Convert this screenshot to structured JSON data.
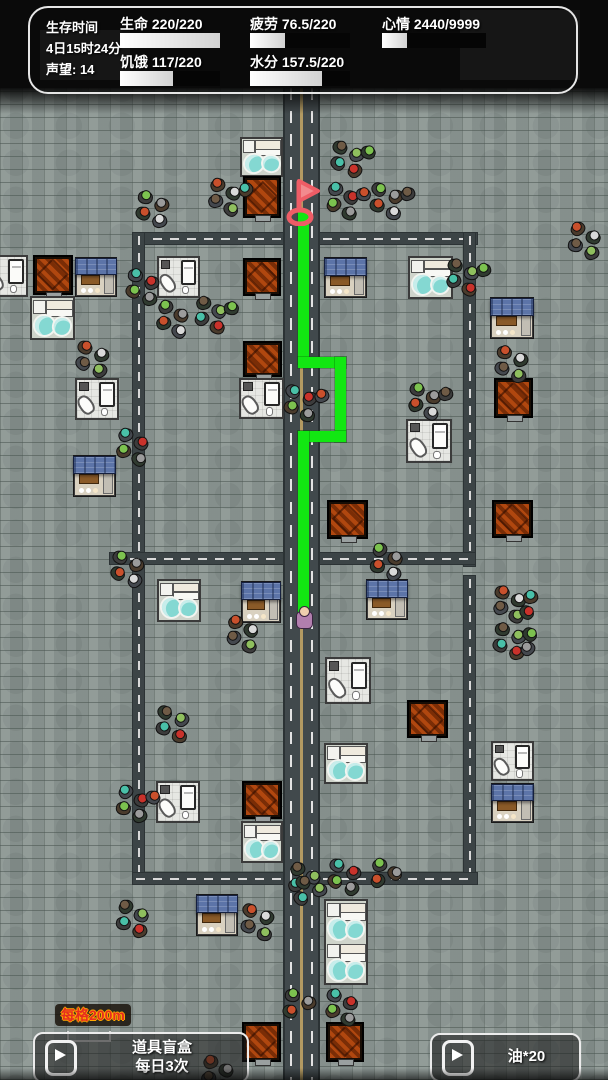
{
  "hud": {
    "left_column": {
      "line1": "生存时间",
      "line2": "4日15时24分",
      "line3": "声望: 14"
    },
    "stats": [
      {
        "id": "health",
        "label": "生命",
        "value": "220/220",
        "pct": 100
      },
      {
        "id": "hunger",
        "label": "饥饿",
        "value": "117/220",
        "pct": 53
      },
      {
        "id": "fatigue",
        "label": "疲劳",
        "value": "76.5/220",
        "pct": 35
      },
      {
        "id": "water",
        "label": "水分",
        "value": "157.5/220",
        "pct": 72
      },
      {
        "id": "mood",
        "label": "心情",
        "value": "2440/9999",
        "pct": 24
      }
    ]
  },
  "footer": {
    "scale_label": "每格200m",
    "blind_box_button": {
      "line1": "道具盲盒",
      "line2": "每日3次"
    },
    "oil_button": {
      "label": "油*20"
    }
  },
  "map": {
    "colors": {
      "cobblestone": "#8c9793",
      "path_green": "#12e712",
      "flag_red": "#ee5d66",
      "flag_fill": "#f28a8e",
      "center_line": "#b39a62",
      "awning_blue": "#5c74a8",
      "pool_cyan": "#84d8d2",
      "crate_orange": "#b0470f"
    },
    "roads": {
      "main": {
        "x": 283,
        "y": 88,
        "w": 37,
        "h": 992
      },
      "lanes": [
        {
          "x": 133,
          "y": 233,
          "w": 344,
          "h": 11
        },
        {
          "x": 133,
          "y": 233,
          "w": 11,
          "h": 651
        },
        {
          "x": 464,
          "y": 233,
          "w": 11,
          "h": 333
        },
        {
          "x": 464,
          "y": 576,
          "w": 11,
          "h": 308
        },
        {
          "x": 110,
          "y": 553,
          "w": 173,
          "h": 11
        },
        {
          "x": 320,
          "y": 553,
          "w": 155,
          "h": 11
        },
        {
          "x": 133,
          "y": 873,
          "w": 344,
          "h": 11
        }
      ]
    },
    "buildings": [
      {
        "type": "bath",
        "x": 240,
        "y": 137,
        "w": 43,
        "h": 40
      },
      {
        "type": "crate",
        "x": 243,
        "y": 176,
        "w": 38,
        "h": 42
      },
      {
        "type": "bedroom",
        "x": -16,
        "y": 255,
        "w": 44,
        "h": 42
      },
      {
        "type": "crate",
        "x": 33,
        "y": 255,
        "w": 40,
        "h": 40
      },
      {
        "type": "shop",
        "x": 75,
        "y": 257,
        "w": 42,
        "h": 40
      },
      {
        "type": "bath",
        "x": 30,
        "y": 296,
        "w": 45,
        "h": 44
      },
      {
        "type": "bedroom",
        "x": 157,
        "y": 256,
        "w": 43,
        "h": 42
      },
      {
        "type": "crate",
        "x": 243,
        "y": 258,
        "w": 38,
        "h": 38
      },
      {
        "type": "crate",
        "x": 243,
        "y": 341,
        "w": 39,
        "h": 36
      },
      {
        "type": "bedroom",
        "x": 75,
        "y": 378,
        "w": 44,
        "h": 42
      },
      {
        "type": "bedroom",
        "x": 239,
        "y": 378,
        "w": 45,
        "h": 41
      },
      {
        "type": "shop",
        "x": 324,
        "y": 257,
        "w": 43,
        "h": 41
      },
      {
        "type": "bath",
        "x": 408,
        "y": 256,
        "w": 45,
        "h": 43
      },
      {
        "type": "shop",
        "x": 490,
        "y": 297,
        "w": 44,
        "h": 42
      },
      {
        "type": "crate",
        "x": 494,
        "y": 378,
        "w": 39,
        "h": 40
      },
      {
        "type": "bedroom",
        "x": 406,
        "y": 419,
        "w": 46,
        "h": 44
      },
      {
        "type": "crate",
        "x": 327,
        "y": 500,
        "w": 41,
        "h": 39
      },
      {
        "type": "crate",
        "x": 492,
        "y": 500,
        "w": 41,
        "h": 38
      },
      {
        "type": "shop",
        "x": 73,
        "y": 455,
        "w": 43,
        "h": 42
      },
      {
        "type": "bath",
        "x": 157,
        "y": 579,
        "w": 44,
        "h": 43
      },
      {
        "type": "shop",
        "x": 241,
        "y": 581,
        "w": 40,
        "h": 42
      },
      {
        "type": "shop",
        "x": 366,
        "y": 579,
        "w": 42,
        "h": 41
      },
      {
        "type": "bedroom",
        "x": 325,
        "y": 657,
        "w": 46,
        "h": 47
      },
      {
        "type": "bath",
        "x": 324,
        "y": 743,
        "w": 44,
        "h": 41
      },
      {
        "type": "crate",
        "x": 407,
        "y": 700,
        "w": 41,
        "h": 38
      },
      {
        "type": "bedroom",
        "x": 491,
        "y": 741,
        "w": 43,
        "h": 40
      },
      {
        "type": "shop",
        "x": 491,
        "y": 783,
        "w": 43,
        "h": 40
      },
      {
        "type": "bedroom",
        "x": 156,
        "y": 781,
        "w": 44,
        "h": 42
      },
      {
        "type": "crate",
        "x": 242,
        "y": 781,
        "w": 40,
        "h": 38
      },
      {
        "type": "bath",
        "x": 241,
        "y": 821,
        "w": 42,
        "h": 42
      },
      {
        "type": "shop",
        "x": 196,
        "y": 894,
        "w": 42,
        "h": 42
      },
      {
        "type": "bath2",
        "x": 324,
        "y": 899,
        "w": 44,
        "h": 86
      },
      {
        "type": "crate",
        "x": 242,
        "y": 1022,
        "w": 39,
        "h": 40
      },
      {
        "type": "crate",
        "x": 326,
        "y": 1022,
        "w": 38,
        "h": 40
      }
    ],
    "path": {
      "segments": [
        {
          "x": 298,
          "y": 212,
          "w": 11,
          "h": 152
        },
        {
          "x": 298,
          "y": 357,
          "w": 48,
          "h": 11
        },
        {
          "x": 335,
          "y": 357,
          "w": 11,
          "h": 85
        },
        {
          "x": 298,
          "y": 431,
          "w": 48,
          "h": 11
        },
        {
          "x": 298,
          "y": 431,
          "w": 11,
          "h": 186
        }
      ]
    },
    "flag": {
      "x": 285,
      "y": 176
    },
    "player": {
      "x": 296,
      "y": 606
    },
    "zombie_head_colors": [
      "#7cc24f",
      "#9b9b9b",
      "#c9502c",
      "#d9d9d9",
      "#6f5b46",
      "#8fbf5e",
      "#49c0a8",
      "#c9322b"
    ],
    "zombie_body_colors": [
      "#3c3c3c",
      "#4a3b2c",
      "#2f3a2f",
      "#44484e"
    ],
    "zombie_clusters": [
      {
        "x": 138,
        "y": 190,
        "n": 4
      },
      {
        "x": 210,
        "y": 178,
        "n": 5
      },
      {
        "x": 333,
        "y": 140,
        "n": 5
      },
      {
        "x": 328,
        "y": 182,
        "n": 5
      },
      {
        "x": 372,
        "y": 182,
        "n": 5
      },
      {
        "x": 570,
        "y": 222,
        "n": 4
      },
      {
        "x": 448,
        "y": 258,
        "n": 5
      },
      {
        "x": 128,
        "y": 268,
        "n": 4
      },
      {
        "x": 158,
        "y": 300,
        "n": 4
      },
      {
        "x": 78,
        "y": 340,
        "n": 4
      },
      {
        "x": 196,
        "y": 296,
        "n": 5
      },
      {
        "x": 286,
        "y": 384,
        "n": 5
      },
      {
        "x": 372,
        "y": 543,
        "n": 4
      },
      {
        "x": 495,
        "y": 585,
        "n": 6
      },
      {
        "x": 495,
        "y": 622,
        "n": 6
      },
      {
        "x": 118,
        "y": 428,
        "n": 4
      },
      {
        "x": 113,
        "y": 550,
        "n": 4
      },
      {
        "x": 228,
        "y": 615,
        "n": 4
      },
      {
        "x": 158,
        "y": 705,
        "n": 4
      },
      {
        "x": 118,
        "y": 785,
        "n": 5
      },
      {
        "x": 410,
        "y": 382,
        "n": 5
      },
      {
        "x": 497,
        "y": 345,
        "n": 4
      },
      {
        "x": 290,
        "y": 862,
        "n": 3
      },
      {
        "x": 330,
        "y": 858,
        "n": 4
      },
      {
        "x": 372,
        "y": 858,
        "n": 3
      },
      {
        "x": 243,
        "y": 903,
        "n": 4
      },
      {
        "x": 118,
        "y": 900,
        "n": 4
      },
      {
        "x": 327,
        "y": 988,
        "n": 4
      },
      {
        "x": 285,
        "y": 988,
        "n": 3
      },
      {
        "x": 203,
        "y": 1055,
        "n": 4
      },
      {
        "x": 296,
        "y": 875,
        "n": 3
      }
    ]
  }
}
